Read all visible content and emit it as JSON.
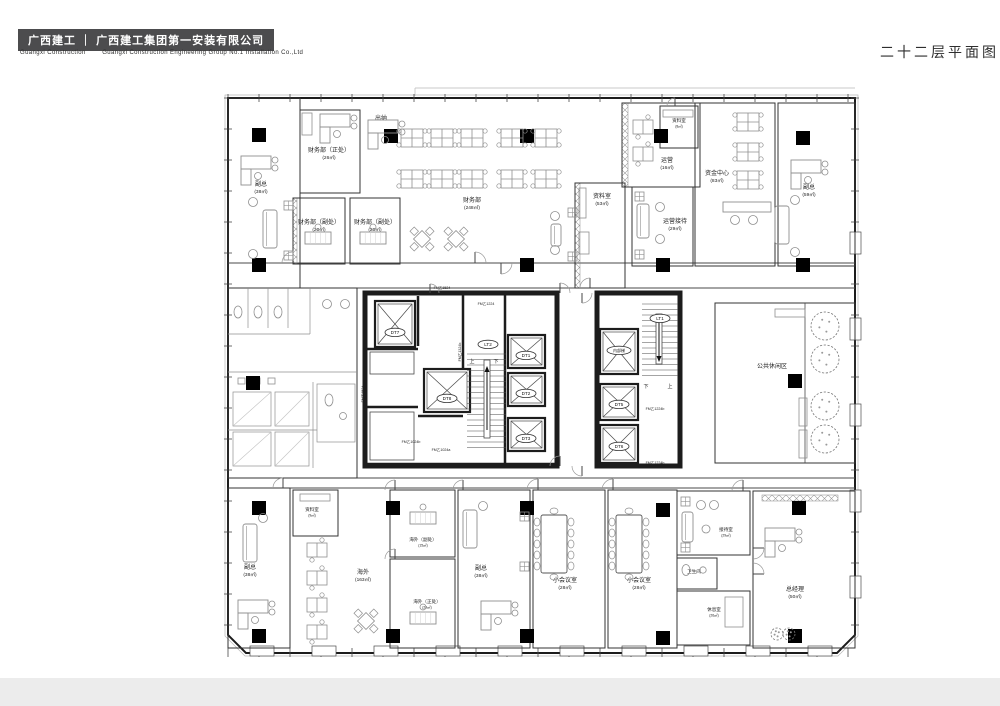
{
  "header": {
    "logo_text": "广西建工 ｜ 广西建工集团第一安装有限公司",
    "subtitle_en": "Guangxi Construction        Guangxi Construction Engineering Group No.1 Installation Co.,Ltd",
    "drawing_title": "二十二层平面图",
    "logo_bg": "#4c4c4e"
  },
  "plan": {
    "line_color": "#1c1c1c",
    "thin_color": "#4a4a4a",
    "furniture_color": "#8f8f8f",
    "rooms": [
      {
        "id": "vp_tl",
        "name": "副总",
        "area": "(38㎡)"
      },
      {
        "id": "cw_zc",
        "name": "财务部（正处）",
        "area": "(26㎡)"
      },
      {
        "id": "cw_fc1",
        "name": "财务部（副处）",
        "area": "(20㎡)"
      },
      {
        "id": "cw_fc2",
        "name": "财务部（副处）",
        "area": "(20㎡)"
      },
      {
        "id": "cashier",
        "name": "出纳",
        "area": ""
      },
      {
        "id": "cwb",
        "name": "财务部",
        "area": "(248㎡)"
      },
      {
        "id": "zl8",
        "name": "资料室",
        "area": "(8㎡)"
      },
      {
        "id": "yy",
        "name": "运营",
        "area": "(16㎡)"
      },
      {
        "id": "yyjd",
        "name": "运营接待",
        "area": "(29㎡)"
      },
      {
        "id": "zl53",
        "name": "资料室",
        "area": "(53㎡)"
      },
      {
        "id": "zjzx",
        "name": "资金中心",
        "area": "(83㎡)"
      },
      {
        "id": "vp_tr",
        "name": "副总",
        "area": "(59㎡)"
      },
      {
        "id": "leisure",
        "name": "公共休闲区",
        "area": ""
      },
      {
        "id": "vp_bl",
        "name": "副总",
        "area": "(38㎡)"
      },
      {
        "id": "zl9",
        "name": "资料室",
        "area": "(9㎡)"
      },
      {
        "id": "hw",
        "name": "海外",
        "area": "(163㎡)"
      },
      {
        "id": "hw_fc",
        "name": "海外（副处）",
        "area": "(15㎡)"
      },
      {
        "id": "hw_zc",
        "name": "海外（正处）",
        "area": "(20㎡)"
      },
      {
        "id": "vp_bm",
        "name": "副总",
        "area": "(38㎡)"
      },
      {
        "id": "mt1",
        "name": "小会议室",
        "area": "(28㎡)"
      },
      {
        "id": "mt2",
        "name": "小会议室",
        "area": "(28㎡)"
      },
      {
        "id": "reception",
        "name": "接待室",
        "area": "(29㎡)"
      },
      {
        "id": "wc_s",
        "name": "卫生间",
        "area": ""
      },
      {
        "id": "rest",
        "name": "休息室",
        "area": "(26㎡)"
      },
      {
        "id": "gm",
        "name": "总经理",
        "area": "(50㎡)"
      }
    ],
    "elevators": [
      "DT7",
      "DT8",
      "DT1",
      "DT2",
      "DT3",
      "内部梯",
      "DT5",
      "DT6"
    ],
    "stairs": {
      "lt2": "LT2",
      "lt1": "LT1",
      "up": "上",
      "down": "下"
    },
    "door_codes": [
      "FM乙1524",
      "FM乙1224",
      "FM乙1324b",
      "FM乙1524",
      "FM乙1024b",
      "FM乙1024a",
      "FM乙1224b",
      "FM乙1224b"
    ]
  }
}
